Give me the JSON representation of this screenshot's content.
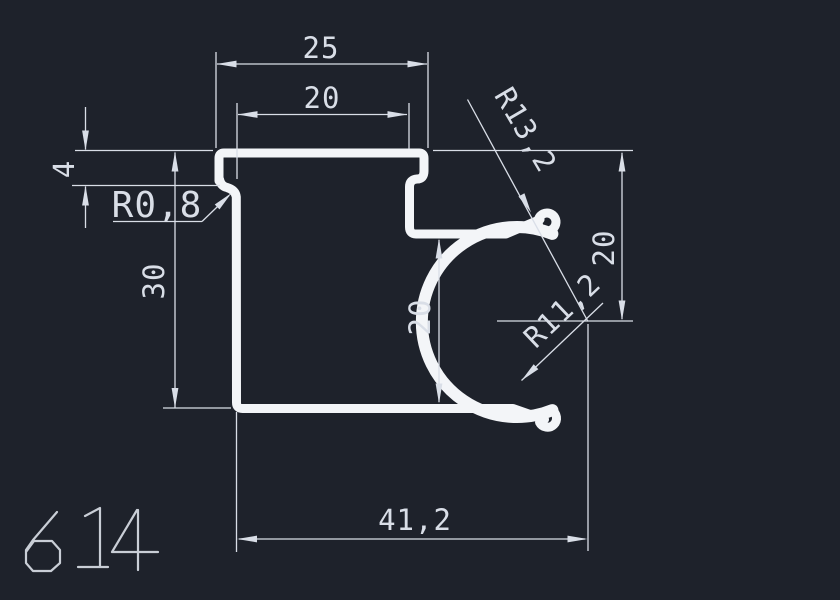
{
  "drawing": {
    "type": "CAD profile cross-section",
    "part_number": "614",
    "colors": {
      "background": "#1e222b",
      "profile_stroke": "#f3f5f8",
      "dimension_stroke": "#d9dee7",
      "part_number_stroke": "#c9ced6"
    },
    "dimensions": {
      "top_width": "25",
      "top_inner_width": "20",
      "lip_height": "4",
      "left_height": "30",
      "fillet_radius": "R0,8",
      "outer_radius": "R13,2",
      "inner_radius": "R11,2",
      "mid_height": "20",
      "right_height": "20",
      "bottom_width": "41,2"
    }
  }
}
